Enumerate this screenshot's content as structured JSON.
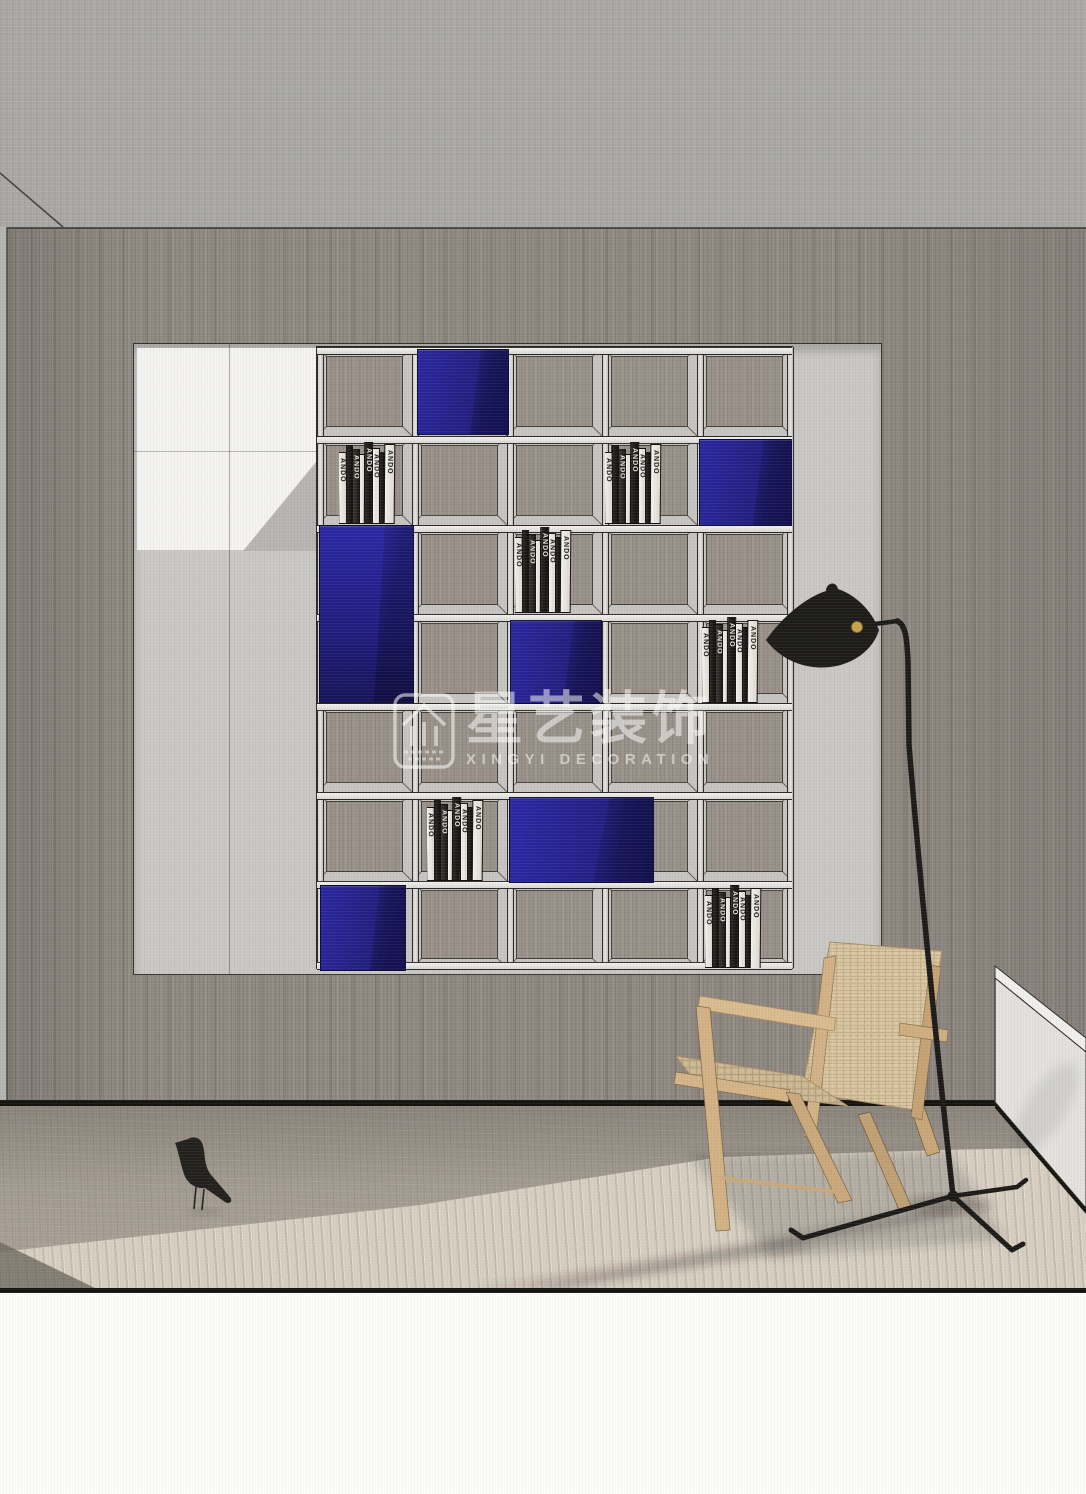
{
  "watermark": {
    "brand_cn": "星艺装饰",
    "brand_en": "XINGYI DECORATION"
  },
  "shelf": {
    "rows": 7,
    "cols": 5,
    "row_lines": [
      0,
      89,
      178,
      267,
      356,
      445,
      534,
      621
    ],
    "col_lines": [
      0,
      95,
      190,
      285,
      380,
      475
    ],
    "book_spine_text": "ANDO",
    "book_pattern": [
      {
        "c": "white",
        "w": 9,
        "hp": 88,
        "t": 1,
        "r": -5
      },
      {
        "c": "black",
        "w": 7,
        "hp": 96,
        "t": 0,
        "r": 0
      },
      {
        "c": "dark",
        "w": 8,
        "hp": 92,
        "t": 1,
        "r": 0
      },
      {
        "c": "white",
        "w": 6,
        "hp": 85,
        "t": 0,
        "r": 0
      },
      {
        "c": "black",
        "w": 9,
        "hp": 100,
        "t": 1,
        "r": 3
      },
      {
        "c": "white",
        "w": 8,
        "hp": 93,
        "t": 1,
        "r": 0
      },
      {
        "c": "black",
        "w": 6,
        "hp": 88,
        "t": 0,
        "r": 0
      },
      {
        "c": "white",
        "w": 11,
        "hp": 97,
        "t": 1,
        "r": 5
      }
    ],
    "features": [
      {
        "type": "blue",
        "x": 100,
        "y": 2,
        "w": 90,
        "h": 84
      },
      {
        "type": "books",
        "x": 22,
        "y": 95,
        "w": 70,
        "h": 82
      },
      {
        "type": "books",
        "x": 288,
        "y": 95,
        "w": 62,
        "h": 82
      },
      {
        "type": "blue",
        "x": 382,
        "y": 92,
        "w": 91,
        "h": 85
      },
      {
        "type": "blue_tall",
        "x": 2,
        "y": 178,
        "w": 93,
        "h": 176
      },
      {
        "type": "books",
        "x": 198,
        "y": 180,
        "w": 72,
        "h": 86
      },
      {
        "type": "blue",
        "x": 193,
        "y": 273,
        "w": 90,
        "h": 82
      },
      {
        "type": "books",
        "x": 385,
        "y": 270,
        "w": 78,
        "h": 86
      },
      {
        "type": "books",
        "x": 110,
        "y": 450,
        "w": 75,
        "h": 84
      },
      {
        "type": "blue_wide",
        "x": 192,
        "y": 450,
        "w": 143,
        "h": 84
      },
      {
        "type": "blue",
        "x": 3,
        "y": 538,
        "w": 84,
        "h": 84
      },
      {
        "type": "books",
        "x": 388,
        "y": 538,
        "w": 75,
        "h": 83
      }
    ]
  },
  "colors": {
    "accent_blue": "#221f7e",
    "wood_wall": "#8f8982",
    "niche_bg": "#cac8c5",
    "floor_light": "#d6cfc1",
    "lamp_black": "#1c1b19",
    "brass": "#c9a24a",
    "chair_wood": "#d2b185",
    "chair_weave": "#dbc9a6"
  }
}
